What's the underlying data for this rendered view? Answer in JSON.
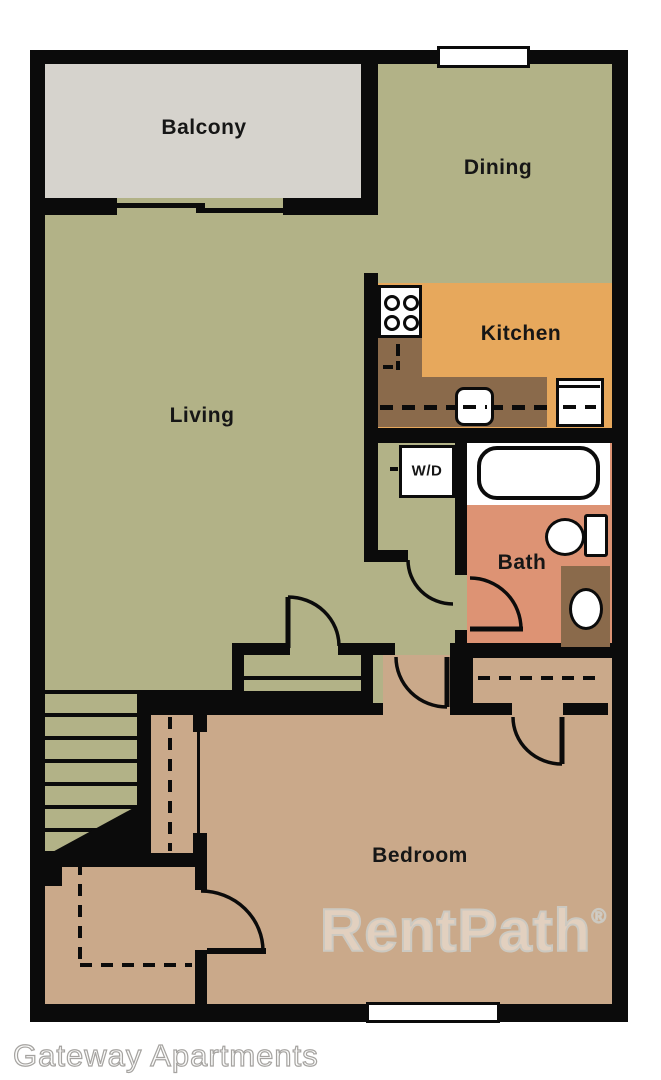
{
  "rooms": {
    "balcony": "Balcony",
    "dining": "Dining",
    "kitchen": "Kitchen",
    "living": "Living",
    "washer_dryer": "W/D",
    "bath": "Bath",
    "bedroom": "Bedroom"
  },
  "fixtures": [
    "stove",
    "kitchen-sink",
    "refrigerator",
    "bathtub",
    "toilet",
    "vanity-sink",
    "stairs",
    "closet",
    "sliding-door",
    "window"
  ],
  "watermark": {
    "text": "RentPath",
    "registered_mark": "®"
  },
  "caption": "Gateway Apartments",
  "colors": {
    "wall": "#0b0b0b",
    "floor_main": "#b2b287",
    "balcony": "#d6d3cd",
    "kitchen": "#e7a85c",
    "counter": "#8a6a4b",
    "bath": "#dd9374",
    "bedroom": "#caa98a",
    "fixture_fill": "#ffffff"
  }
}
